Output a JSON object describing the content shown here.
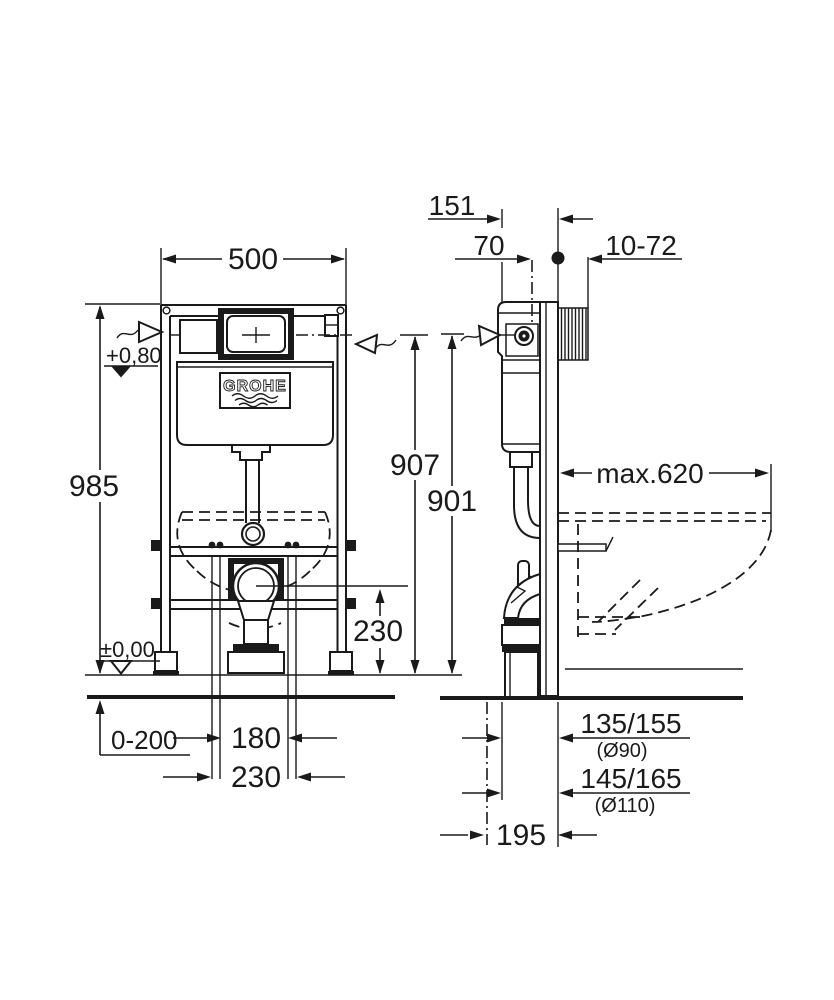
{
  "brand_logo": "GROHE",
  "front_view": {
    "frame_width": "500",
    "frame_height": "985",
    "level_actuation": "+0,80",
    "level_floor": "±0,00",
    "foot_adjust": "0-200",
    "fixing_inner": "180",
    "fixing_outer": "230",
    "outlet_height": "230"
  },
  "side_view": {
    "depth_top": "151",
    "supply_depth": "70",
    "wall_thickness": "10-72",
    "height_supply": "907",
    "height_actuation": "901",
    "bowl_depth": "max.620",
    "outlet_pos_90": "135/155",
    "outlet_dia_90": "(Ø90)",
    "outlet_pos_110": "145/165",
    "outlet_dia_110": "(Ø110)",
    "outlet_offset": "195"
  }
}
